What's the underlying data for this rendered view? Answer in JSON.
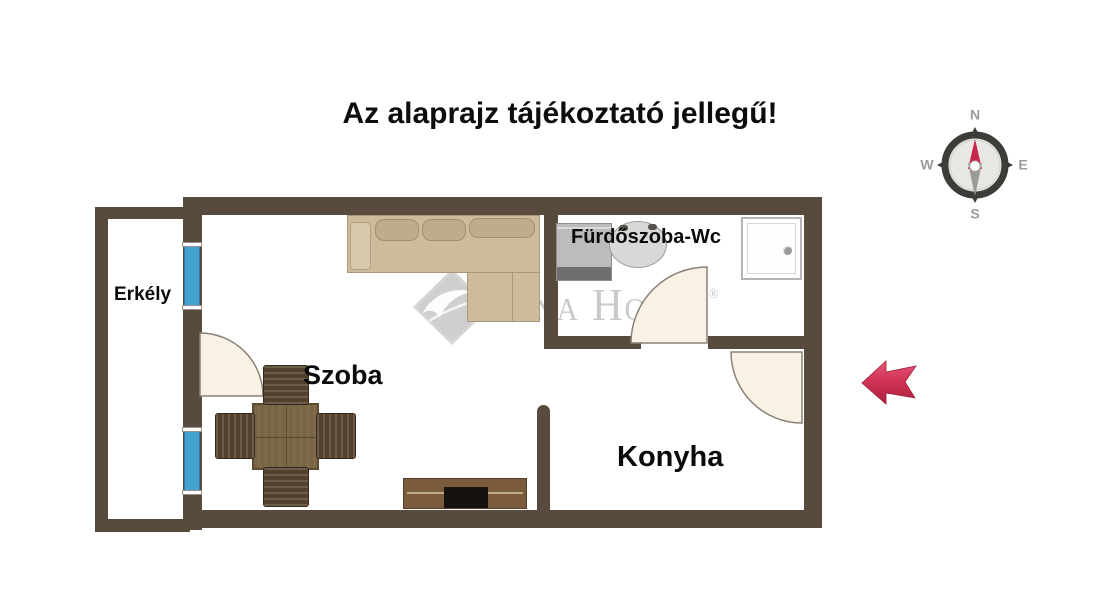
{
  "disclaimer": "Az alaprajz tájékoztató jellegű!",
  "rooms": {
    "balcony": "Erkély",
    "room": "Szoba",
    "bathroom": "Fürdőszoba-Wc",
    "kitchen": "Konyha"
  },
  "compass": {
    "north": "N",
    "east": "E",
    "south": "S",
    "west": "W"
  },
  "watermark": {
    "text": "Duna House",
    "reg": "®"
  },
  "colors": {
    "wall": "#584a3d",
    "window_blue": "#45a3d2",
    "door_leaf": "#f9f1e4",
    "sofa_beige": "#cdbb9e",
    "wood_brown": "#7e6a49",
    "chair_brown": "#53412e",
    "arrow_red": "#cf3154",
    "needle_red": "#c6274b",
    "watermark_gray": "#a8a8a8"
  }
}
